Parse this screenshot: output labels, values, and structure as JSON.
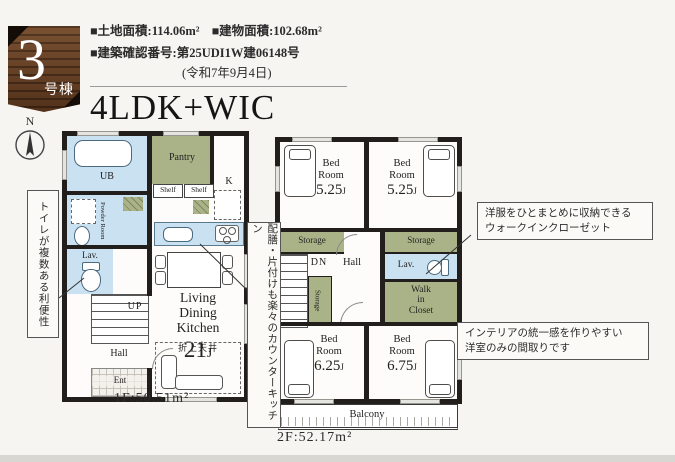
{
  "colors": {
    "accent_green": "#aab387",
    "accent_blue": "#c9e1f1",
    "wall": "#211e1b",
    "badge_wood": "#5a3a24",
    "page_bg": "#f7f5f1"
  },
  "badge": {
    "number": "3",
    "suffix": "号棟"
  },
  "header": {
    "land_area": "■土地面積:114.06m²",
    "building_area": "■建物面積:102.68m²",
    "confirmation": "■建築確認番号:第25UDI1W建06148号",
    "confirmation_date": "(令和7年9月4日)",
    "title": "4LDK+WIC"
  },
  "compass": {
    "north": "N"
  },
  "floor1": {
    "area_label": "1F:50.51m²",
    "labels": {
      "ub": "UB",
      "powder_room": "Powder Room",
      "lav": "Lav.",
      "up": "UP",
      "hall": "Hall",
      "ent": "Ent",
      "pantry": "Pantry",
      "shelf_left": "Shelf",
      "shelf_right": "Shelf",
      "kitchen": "K",
      "ldk_line1": "Living",
      "ldk_line2": "Dining",
      "ldk_line3": "Kitchen",
      "ldk_size": "21",
      "ldk_unit": "J",
      "ceiling_note": "折上天井"
    }
  },
  "floor2": {
    "area_label": "2F:52.17m²",
    "unit": "J",
    "bedrooms": [
      {
        "name_line1": "Bed",
        "name_line2": "Room",
        "size": "5.25"
      },
      {
        "name_line1": "Bed",
        "name_line2": "Room",
        "size": "5.25"
      },
      {
        "name_line1": "Bed",
        "name_line2": "Room",
        "size": "6.25"
      },
      {
        "name_line1": "Bed",
        "name_line2": "Room",
        "size": "6.75"
      }
    ],
    "labels": {
      "storage_left": "Storage",
      "storage_right": "Storage",
      "storage_mid": "Storage",
      "dn": "DN",
      "hall": "Hall",
      "lav": "Lav.",
      "wic_line1": "Walk",
      "wic_line2": "in",
      "wic_line3": "Closet",
      "balcony": "Balcony"
    }
  },
  "annotations": {
    "toilet_note": "トイレが複数ある利便性",
    "kitchen_note": "配膳・片付けも楽々のカウンターキッチン",
    "wic_note_line1": "洋服をひとまとめに収納できる",
    "wic_note_line2": "ウォークインクローゼット",
    "interior_note_line1": "インテリアの統一感を作りやすい",
    "interior_note_line2": "洋室のみの間取りです"
  }
}
